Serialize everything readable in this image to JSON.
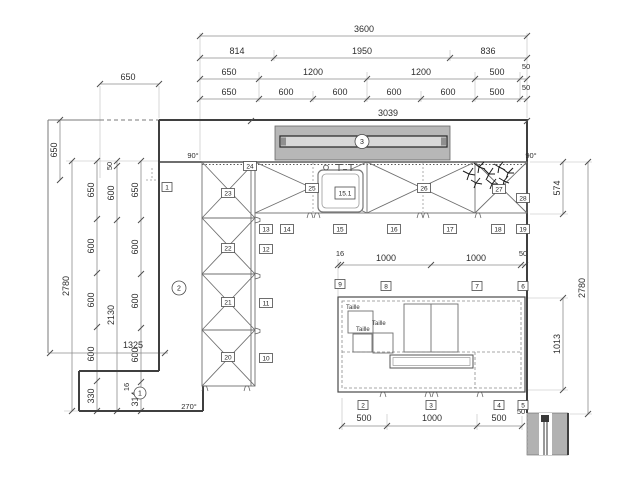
{
  "dims": {
    "top_total": "3600",
    "top_row2": [
      "814",
      "1950",
      "836"
    ],
    "top_row3": [
      "650",
      "1200",
      "1200",
      "500"
    ],
    "top_row3_gap": "50",
    "top_row4": [
      "650",
      "600",
      "600",
      "600",
      "600",
      "500"
    ],
    "top_row4_gap": "50",
    "top_left_offset": "650",
    "window_width": "3039",
    "left_top": "650",
    "left_overall": "2780",
    "left_chain_c": [
      "650",
      "600",
      "600",
      "600",
      "330"
    ],
    "left_chain_d": [
      "50",
      "600",
      "2130"
    ],
    "left_chain_e": [
      "650",
      "600",
      "600",
      "600",
      "16",
      "314"
    ],
    "left_bottom_width": "1325",
    "right_counter_depth": "574",
    "right_overall": "2780",
    "right_island_depth": "1013",
    "mid_gap": "16",
    "mid_seg1": "1000",
    "mid_seg2": "1000",
    "mid_gap_right": "50",
    "bottom_seg1": "500",
    "bottom_seg2": "1000",
    "bottom_seg3": "500",
    "bottom_gap_right": "50",
    "angle_top_left": "90°",
    "angle_top_right": "90°",
    "angle_bottom": "270°"
  },
  "labels": {
    "squares": [
      "1",
      "2",
      "3",
      "4",
      "5",
      "6",
      "7",
      "8",
      "9",
      "10",
      "11",
      "12",
      "13",
      "14",
      "15",
      "16",
      "17",
      "18",
      "19",
      "20",
      "21",
      "22",
      "23",
      "24",
      "25",
      "26",
      "27",
      "28"
    ],
    "circles": [
      "1",
      "2",
      "3"
    ],
    "sink": "15.1",
    "size_tag": "Taille"
  }
}
